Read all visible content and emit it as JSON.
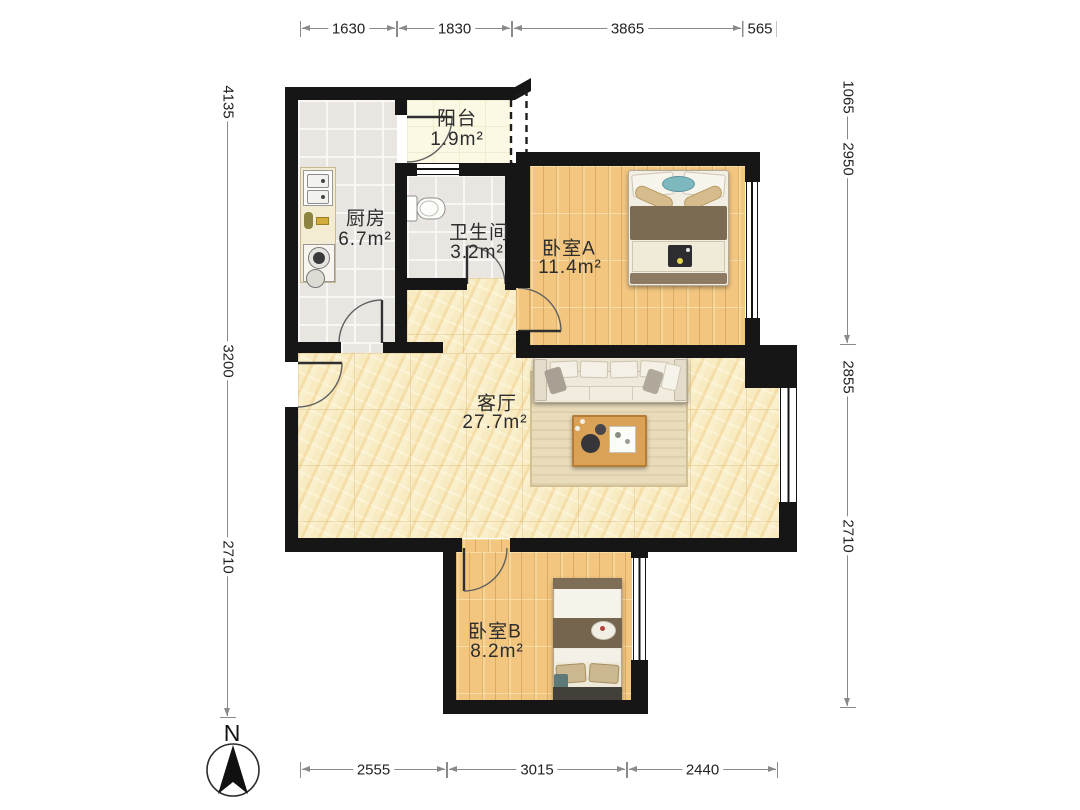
{
  "rooms": {
    "balcony": {
      "name": "阳台",
      "area": "1.9m²"
    },
    "kitchen": {
      "name": "厨房",
      "area": "6.7m²"
    },
    "bathroom": {
      "name": "卫生间",
      "area": "3.2m²"
    },
    "bedroom_a": {
      "name": "卧室A",
      "area": "11.4m²"
    },
    "living_room": {
      "name": "客厅",
      "area": "27.7m²"
    },
    "bedroom_b": {
      "name": "卧室B",
      "area": "8.2m²"
    }
  },
  "dimensions": {
    "top": [
      {
        "label": "1630"
      },
      {
        "label": "1830"
      },
      {
        "label": "3865"
      },
      {
        "label": "565"
      }
    ],
    "bottom": [
      {
        "label": "2555"
      },
      {
        "label": "3015"
      },
      {
        "label": "2440"
      }
    ],
    "left": [
      {
        "label": "4135"
      },
      {
        "label": "3200"
      },
      {
        "label": "2710"
      }
    ],
    "right": [
      {
        "label": "1065"
      },
      {
        "label": "2950"
      },
      {
        "label": "2855"
      },
      {
        "label": "2710"
      }
    ]
  },
  "compass": {
    "label": "N"
  },
  "colors": {
    "wall": "#161616",
    "wood_floor": "#f2c67f",
    "marble_floor": "#f8ebc1",
    "tile_floor": "#e9e6e2",
    "balcony_floor": "#fbf8e4",
    "accent_teal": "#7db8be",
    "dimension_line": "#8a8a8a"
  }
}
